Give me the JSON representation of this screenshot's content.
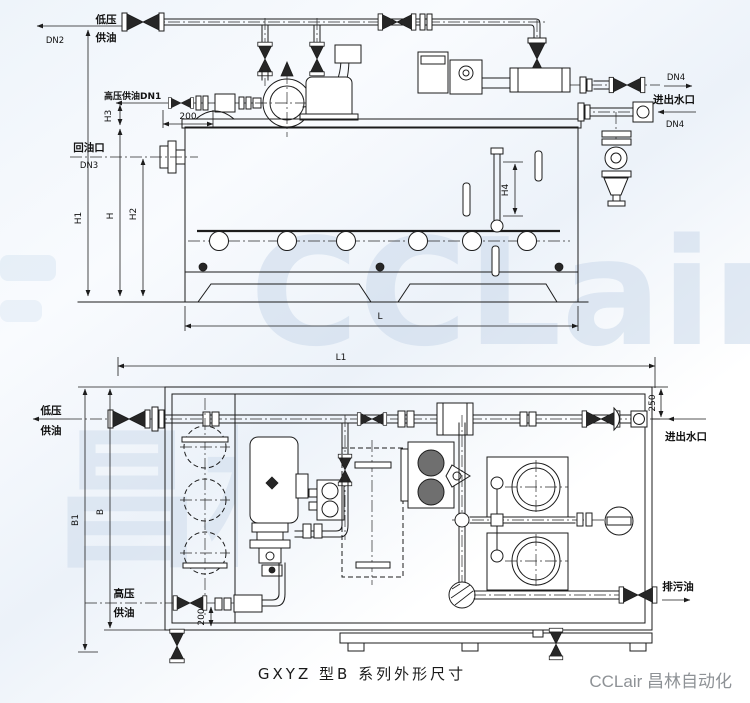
{
  "watermark": {
    "brand": "CCLair",
    "brand_cn": "昌林自动化"
  },
  "caption": "GXYZ 型B 系列外形尺寸",
  "credit": "CCLair 昌林自动化",
  "front": {
    "lp1": "低压",
    "lp2": "供油",
    "dn2": "DN2",
    "hp": "高压供油DN1",
    "h3": "H3",
    "d200": "200",
    "ret1": "回油口",
    "ret2": "DN3",
    "h1": "H1",
    "h": "H",
    "h2": "H2",
    "h4": "H4",
    "l": "L",
    "dn4a": "DN4",
    "water": "进出水口",
    "dn4b": "DN4"
  },
  "plan": {
    "l1": "L1",
    "lp1": "低压",
    "lp2": "供油",
    "d250": "250",
    "water": "进出水口",
    "b1": "B1",
    "b": "B",
    "hp1": "高压",
    "hp2": "供油",
    "d200": "200",
    "drain": "排污油"
  }
}
